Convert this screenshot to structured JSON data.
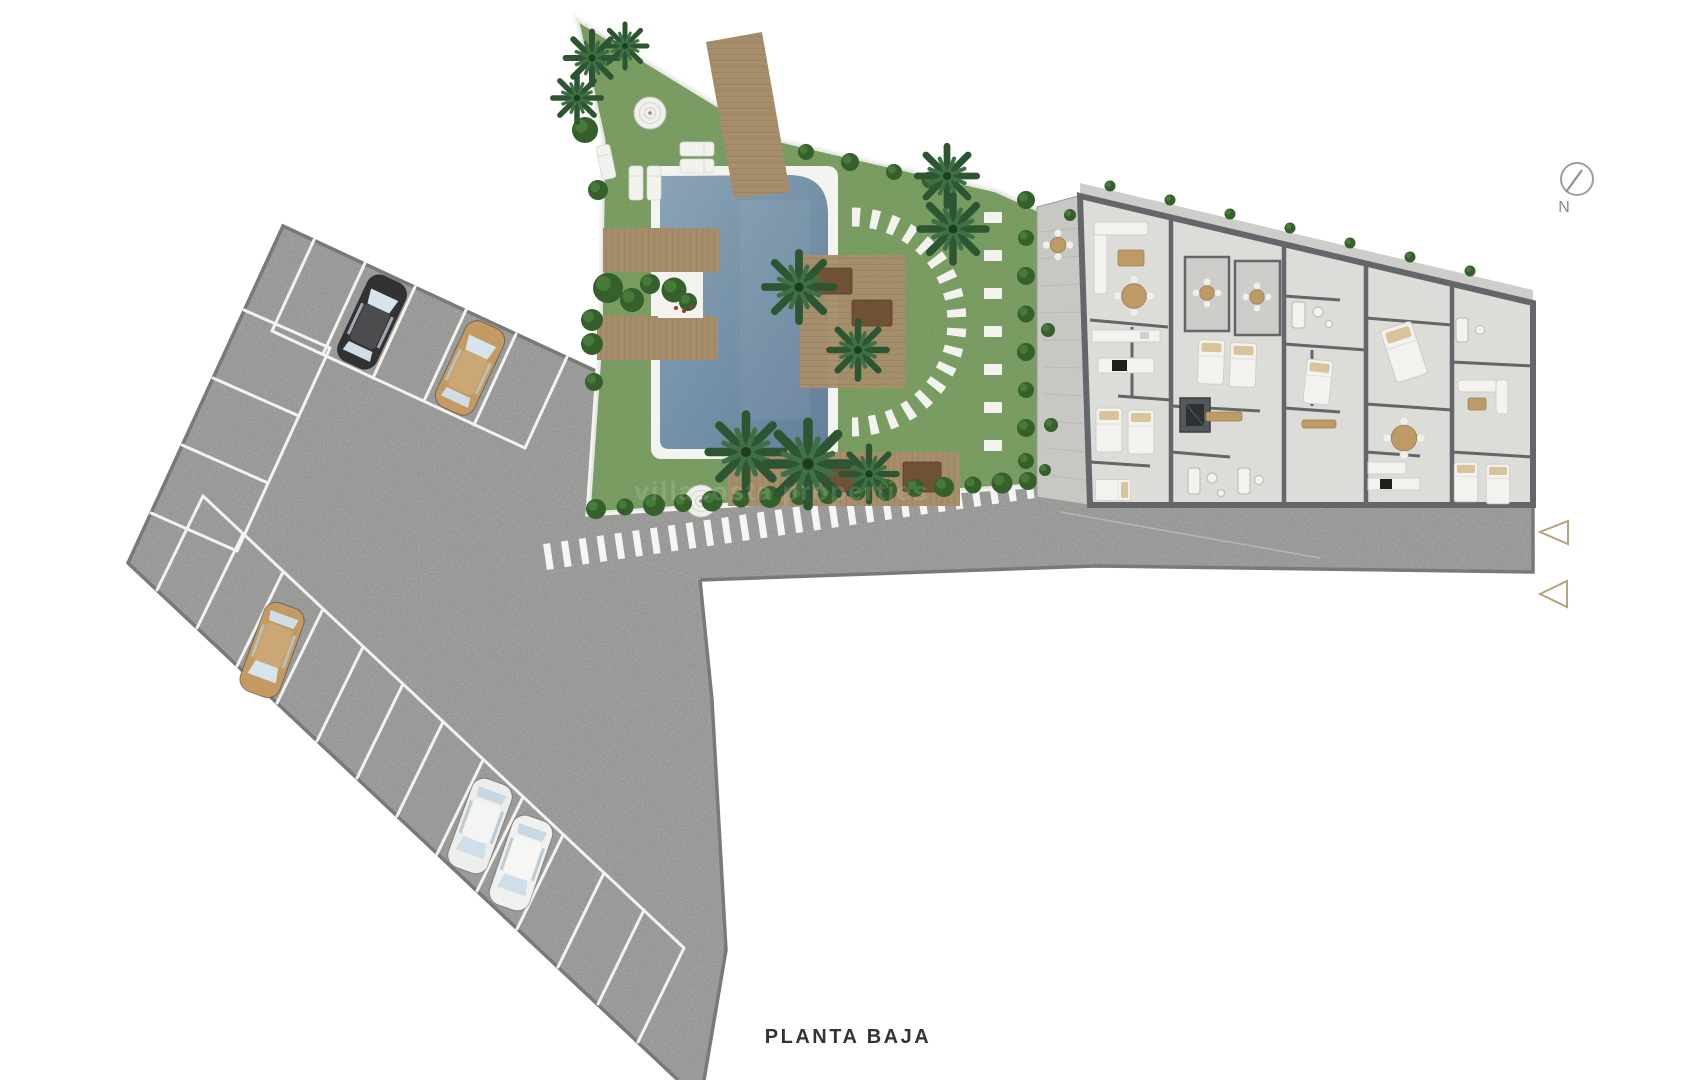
{
  "title": {
    "label": "PLANTA BAJA"
  },
  "compass": {
    "label": "N"
  },
  "watermark": {
    "text": "villacosta properties"
  },
  "parking": {
    "car_count": 5,
    "cars": [
      {
        "id": "car-1",
        "color": "#323234",
        "description": "black car top row"
      },
      {
        "id": "car-2",
        "color": "#c49a62",
        "description": "tan car top row"
      },
      {
        "id": "car-3",
        "color": "#c49a62",
        "description": "tan car bottom row"
      },
      {
        "id": "car-4",
        "color": "#ededeb",
        "description": "white car bottom row"
      },
      {
        "id": "car-5",
        "color": "#f0f0ee",
        "description": "white car bottom row"
      }
    ]
  },
  "colors": {
    "background": "#ffffff",
    "asphalt": "#a9a9a8",
    "curb": "#797978",
    "stall_line": "#f2f2f1",
    "grass": "#80a568",
    "hedge": "#35602c",
    "palm": "#2d5531",
    "pool_rim": "#f3f3f0",
    "pool_water": "#7e97ac",
    "deck_wood": "#a68e6a",
    "pergola_wood": "#9c8157",
    "daybed": "#6f5136",
    "building_floor": "#dcdcd9",
    "building_wall": "#63676a",
    "terrace": "#c7c7c4",
    "patio": "#cdcdca",
    "furniture_white": "#f3f2ee",
    "accent_tan": "#bd9a66",
    "appliance_black": "#1f1f1f",
    "marker_outline": "#b6a47b",
    "compass_stroke": "#9e9e9e",
    "title_text": "#333436"
  }
}
